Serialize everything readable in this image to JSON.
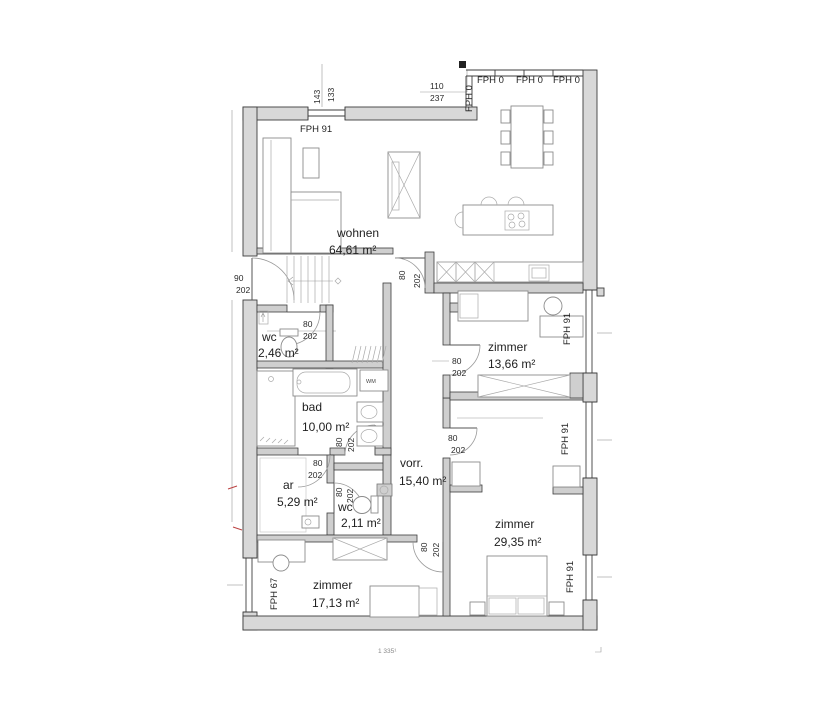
{
  "rooms": [
    {
      "name": "wohnen",
      "area": "64,61 m²"
    },
    {
      "name": "zimmer",
      "area": "13,66 m²"
    },
    {
      "name": "wc",
      "area": "2,46 m²"
    },
    {
      "name": "bad",
      "area": "10,00 m²"
    },
    {
      "name": "ar",
      "area": "5,29 m²"
    },
    {
      "name": "wc",
      "area": "2,11 m²"
    },
    {
      "name": "vorr.",
      "area": "15,40 m²"
    },
    {
      "name": "zimmer",
      "area": "29,35 m²"
    },
    {
      "name": "zimmer",
      "area": "17,13 m²"
    }
  ],
  "windows": {
    "top": "FPH 91",
    "glazing": [
      "FPH 0",
      "FPH 0",
      "FPH 0",
      "FPH 0"
    ],
    "right": [
      "FPH 91",
      "FPH 91",
      "FPH 91"
    ],
    "left": "FPH 67"
  },
  "dims": {
    "top_window_w": "143",
    "top_window_h": "133",
    "corner_glass_w": "110",
    "corner_glass_h": "237",
    "entry_door_w": "90",
    "entry_door_h": "202",
    "door_w": "80",
    "door_h": "202"
  },
  "fixtures": {
    "washing_machine": "WM"
  },
  "footer": {
    "plan_number": "1 335¹"
  }
}
